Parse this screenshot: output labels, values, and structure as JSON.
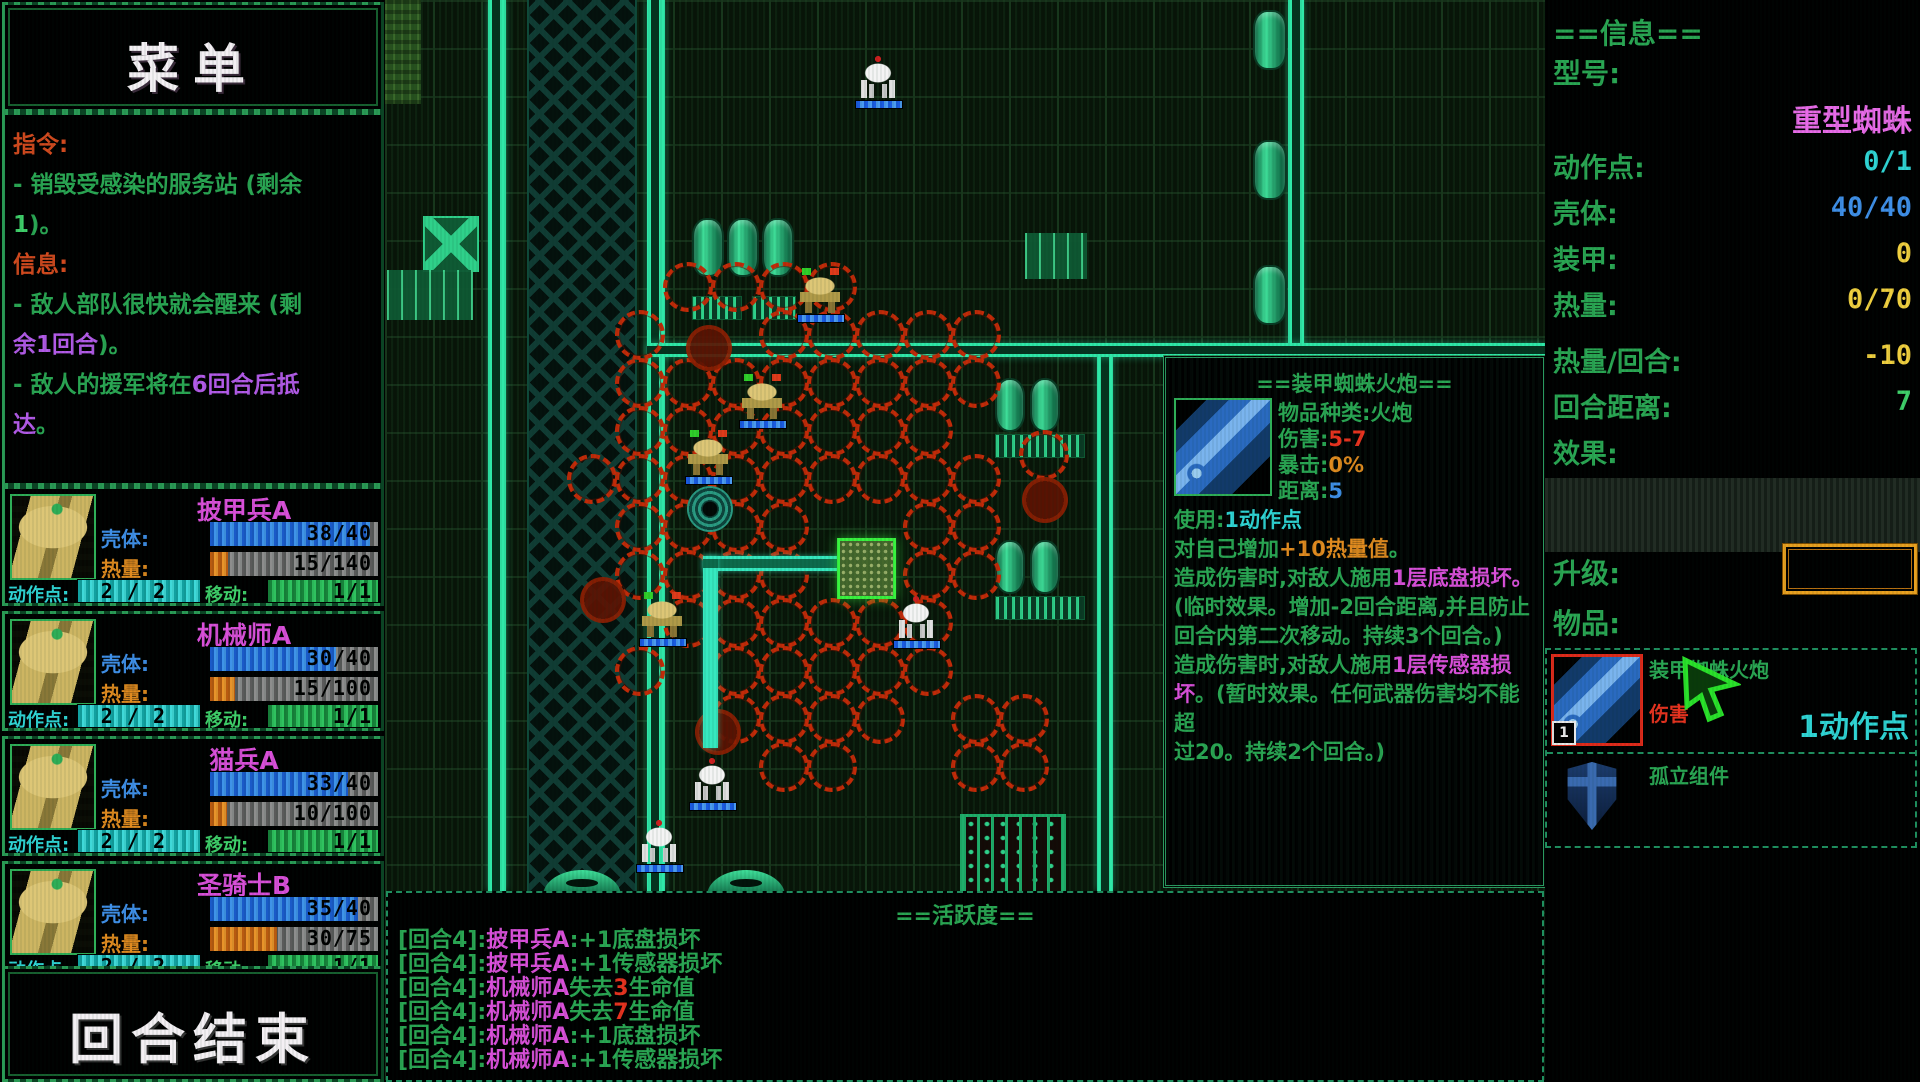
{
  "colors": {
    "accent_green": "#2aa653",
    "magenta": "#d94fd9",
    "cyan": "#2fd4d4",
    "blue": "#3f8fe8",
    "orange": "#e08a1f",
    "yellow": "#f0cf3f",
    "red": "#e8321f",
    "circle_red": "#c22a08",
    "conduit_teal": "#2fe8a8",
    "hp_blue": "#3f93e8"
  },
  "menu": {
    "title": "菜单"
  },
  "mission": {
    "lines": [
      [
        {
          "t": "指令:",
          "c": "o2"
        }
      ],
      [
        {
          "t": "- 销毁受感染的服务站 (剩余",
          "c": "g"
        }
      ],
      [
        {
          "t": "1",
          "c": "gb"
        },
        {
          "t": ")。",
          "c": "g"
        }
      ],
      [
        {
          "t": "信息:",
          "c": "o2"
        }
      ],
      [
        {
          "t": "- 敌人部队很快就会醒来 (剩",
          "c": "g"
        }
      ],
      [
        {
          "t": "余1回合",
          "c": "p"
        },
        {
          "t": ")。",
          "c": "g"
        }
      ],
      [
        {
          "t": "- 敌人的援军将在",
          "c": "g"
        },
        {
          "t": "6回合后抵",
          "c": "p"
        }
      ],
      [
        {
          "t": "达",
          "c": "p"
        },
        {
          "t": "。",
          "c": "g"
        }
      ]
    ]
  },
  "unit_labels": {
    "hull": "壳体:",
    "heat": "热量:",
    "ap": "动作点:",
    "mv": "移动:"
  },
  "units": [
    {
      "name": "披甲兵A",
      "hull": "38/40",
      "hull_pct": 95,
      "heat": "15/140",
      "heat_pct": 11,
      "ap": "2 / 2",
      "mv": "1/1"
    },
    {
      "name": "机械师A",
      "hull": "30/40",
      "hull_pct": 75,
      "heat": "15/100",
      "heat_pct": 15,
      "ap": "2 / 2",
      "mv": "1/1"
    },
    {
      "name": "猫兵A",
      "hull": "33/40",
      "hull_pct": 82,
      "heat": "10/100",
      "heat_pct": 10,
      "ap": "2 / 2",
      "mv": "1/1"
    },
    {
      "name": "圣骑士B",
      "hull": "35/40",
      "hull_pct": 88,
      "heat": "30/75",
      "heat_pct": 40,
      "ap": "2 / 2",
      "mv": "1/1"
    }
  ],
  "end_turn": {
    "label": "回合结束"
  },
  "info": {
    "title": "==信息==",
    "model_label": "型号:",
    "model": "重型蜘蛛",
    "rows": [
      {
        "label": "动作点:",
        "value": "0/1",
        "c": "c",
        "top": 146
      },
      {
        "label": "壳体:",
        "value": "40/40",
        "c": "b",
        "top": 192
      },
      {
        "label": "装甲:",
        "value": "0",
        "c": "y",
        "top": 238
      },
      {
        "label": "热量:",
        "value": "0/70",
        "c": "y",
        "top": 284
      },
      {
        "label": "热量/回合:",
        "value": "-10",
        "c": "y",
        "top": 340
      },
      {
        "label": "回合距离:",
        "value": "7",
        "c": "gb",
        "top": 386
      },
      {
        "label": "效果:",
        "value": "",
        "c": "g",
        "top": 432
      }
    ],
    "upgrade_label": "升级:",
    "items_label": "物品:"
  },
  "items": [
    {
      "name": "装甲蜘蛛火炮",
      "sub": "伤害",
      "ap": "1动作点",
      "badge": "1",
      "icon": "cannon",
      "selected": true
    },
    {
      "name": "孤立组件",
      "icon": "shield",
      "selected": false
    }
  ],
  "tooltip": {
    "title": "==装甲蜘蛛火炮==",
    "stats": [
      [
        {
          "t": "物品种类:火炮",
          "c": "g"
        }
      ],
      [
        {
          "t": "伤害:",
          "c": "g"
        },
        {
          "t": "5-7",
          "c": "r"
        }
      ],
      [
        {
          "t": "暴击:",
          "c": "g"
        },
        {
          "t": "0%",
          "c": "o"
        }
      ],
      [
        {
          "t": "距离:",
          "c": "g"
        },
        {
          "t": "5",
          "c": "b"
        }
      ]
    ],
    "body": [
      [
        {
          "t": "使用:",
          "c": "g"
        },
        {
          "t": "1动作点",
          "c": "c"
        }
      ],
      [
        {
          "t": "对自己增加",
          "c": "g"
        },
        {
          "t": "+10热量值",
          "c": "o"
        },
        {
          "t": "。",
          "c": "g"
        }
      ],
      [
        {
          "t": "造成伤害时,对敌人施用",
          "c": "g"
        },
        {
          "t": "1层底盘损坏。",
          "c": "m"
        }
      ],
      [
        {
          "t": "(临时效果。增加-2回合距离,并且防止",
          "c": "g"
        }
      ],
      [
        {
          "t": "回合内第二次移动。持续3个回合。)",
          "c": "g"
        }
      ],
      [
        {
          "t": "造成伤害时,对敌人施用",
          "c": "g"
        },
        {
          "t": "1层传感器损",
          "c": "m"
        }
      ],
      [
        {
          "t": "坏",
          "c": "m"
        },
        {
          "t": "。(暂时效果。任何武器伤害均不能超",
          "c": "g"
        }
      ],
      [
        {
          "t": "过20。持续2个回合。)",
          "c": "g"
        }
      ]
    ]
  },
  "log": {
    "title": "==活跃度==",
    "lines": [
      [
        {
          "t": "[回合4]:",
          "c": "g"
        },
        {
          "t": "披甲兵A",
          "c": "m"
        },
        {
          "t": ":+1底盘损坏",
          "c": "g"
        }
      ],
      [
        {
          "t": "[回合4]:",
          "c": "g"
        },
        {
          "t": "披甲兵A",
          "c": "m"
        },
        {
          "t": ":+1传感器损坏",
          "c": "g"
        }
      ],
      [
        {
          "t": "[回合4]:",
          "c": "g"
        },
        {
          "t": "机械师A",
          "c": "m"
        },
        {
          "t": "失去",
          "c": "g"
        },
        {
          "t": "3",
          "c": "r"
        },
        {
          "t": "生命值",
          "c": "g"
        }
      ],
      [
        {
          "t": "[回合4]:",
          "c": "g"
        },
        {
          "t": "机械师A",
          "c": "m"
        },
        {
          "t": "失去",
          "c": "g"
        },
        {
          "t": "7",
          "c": "r"
        },
        {
          "t": "生命值",
          "c": "g"
        }
      ],
      [
        {
          "t": "[回合4]:",
          "c": "g"
        },
        {
          "t": "机械师A",
          "c": "m"
        },
        {
          "t": ":+1底盘损坏",
          "c": "g"
        }
      ],
      [
        {
          "t": "[回合4]:",
          "c": "g"
        },
        {
          "t": "机械师A",
          "c": "m"
        },
        {
          "t": ":+1传感器损坏",
          "c": "g"
        }
      ]
    ]
  },
  "map": {
    "tile": 48,
    "hazard": {
      "x": 142,
      "y": 0,
      "w": 106,
      "h": 891
    },
    "lighttiles": {
      "x": 0,
      "y": 0,
      "w": 36,
      "h": 104
    },
    "conduits": [
      {
        "dir": "v",
        "x": 103,
        "y": 0,
        "w": 18,
        "h": 891
      },
      {
        "dir": "v",
        "x": 262,
        "y": 0,
        "w": 18,
        "h": 891
      },
      {
        "dir": "v",
        "x": 712,
        "y": 350,
        "w": 16,
        "h": 541
      },
      {
        "dir": "v",
        "x": 903,
        "y": 0,
        "w": 16,
        "h": 350
      },
      {
        "dir": "h",
        "x": 262,
        "y": 343,
        "w": 898,
        "h": 14
      }
    ],
    "path": [
      {
        "x": 318,
        "y": 556,
        "w": 142,
        "h": 15
      },
      {
        "x": 318,
        "y": 556,
        "w": 15,
        "h": 192
      }
    ],
    "selected": {
      "x": 452,
      "y": 538,
      "w": 53,
      "h": 55
    },
    "circles": [
      [
        300,
        284
      ],
      [
        348,
        284
      ],
      [
        396,
        284
      ],
      [
        444,
        284
      ],
      [
        252,
        332
      ],
      [
        396,
        332
      ],
      [
        444,
        332
      ],
      [
        492,
        332
      ],
      [
        540,
        332
      ],
      [
        588,
        332
      ],
      [
        252,
        380
      ],
      [
        300,
        380
      ],
      [
        348,
        380
      ],
      [
        396,
        380
      ],
      [
        444,
        380
      ],
      [
        492,
        380
      ],
      [
        540,
        380
      ],
      [
        588,
        380
      ],
      [
        252,
        428
      ],
      [
        300,
        428
      ],
      [
        348,
        428
      ],
      [
        396,
        428
      ],
      [
        444,
        428
      ],
      [
        492,
        428
      ],
      [
        540,
        428
      ],
      [
        656,
        452
      ],
      [
        204,
        476
      ],
      [
        252,
        476
      ],
      [
        300,
        476
      ],
      [
        348,
        476
      ],
      [
        396,
        476
      ],
      [
        444,
        476
      ],
      [
        492,
        476
      ],
      [
        540,
        476
      ],
      [
        588,
        476
      ],
      [
        252,
        524
      ],
      [
        300,
        524
      ],
      [
        348,
        524
      ],
      [
        396,
        524
      ],
      [
        540,
        524
      ],
      [
        588,
        524
      ],
      [
        252,
        572
      ],
      [
        300,
        572
      ],
      [
        348,
        572
      ],
      [
        396,
        572
      ],
      [
        540,
        572
      ],
      [
        588,
        572
      ],
      [
        300,
        620
      ],
      [
        348,
        620
      ],
      [
        396,
        620
      ],
      [
        444,
        620
      ],
      [
        492,
        620
      ],
      [
        540,
        620
      ],
      [
        252,
        668
      ],
      [
        348,
        668
      ],
      [
        396,
        668
      ],
      [
        444,
        668
      ],
      [
        492,
        668
      ],
      [
        540,
        668
      ],
      [
        348,
        716
      ],
      [
        396,
        716
      ],
      [
        444,
        716
      ],
      [
        492,
        716
      ],
      [
        588,
        716
      ],
      [
        636,
        716
      ],
      [
        396,
        764
      ],
      [
        444,
        764
      ],
      [
        588,
        764
      ],
      [
        636,
        764
      ]
    ],
    "solids": [
      [
        324,
        348
      ],
      [
        660,
        500
      ],
      [
        218,
        600
      ],
      [
        333,
        732
      ]
    ],
    "units": [
      {
        "t": "spider",
        "x": 470,
        "y": 54
      },
      {
        "t": "spider",
        "x": 508,
        "y": 594
      },
      {
        "t": "spider",
        "x": 304,
        "y": 756
      },
      {
        "t": "spider",
        "x": 251,
        "y": 818
      },
      {
        "t": "mech",
        "x": 412,
        "y": 268
      },
      {
        "t": "mech",
        "x": 354,
        "y": 374
      },
      {
        "t": "mech",
        "x": 300,
        "y": 430
      },
      {
        "t": "mech",
        "x": 254,
        "y": 592
      },
      {
        "t": "vortex",
        "x": 302,
        "y": 486
      }
    ],
    "objects": [
      {
        "t": "cratex",
        "x": 38,
        "y": 216,
        "w": 52,
        "h": 52
      },
      {
        "t": "crates",
        "x": 2,
        "y": 270,
        "w": 86,
        "h": 50
      },
      {
        "t": "crates",
        "x": 640,
        "y": 233,
        "w": 62,
        "h": 46
      },
      {
        "t": "pod",
        "x": 307,
        "y": 218,
        "w": 28,
        "h": 55
      },
      {
        "t": "pod",
        "x": 342,
        "y": 218,
        "w": 28,
        "h": 55
      },
      {
        "t": "pod",
        "x": 377,
        "y": 218,
        "w": 28,
        "h": 55
      },
      {
        "t": "grate",
        "x": 307,
        "y": 296,
        "w": 48,
        "h": 22
      },
      {
        "t": "grate",
        "x": 367,
        "y": 296,
        "w": 42,
        "h": 22
      },
      {
        "t": "pod",
        "x": 868,
        "y": 10,
        "w": 30,
        "h": 56
      },
      {
        "t": "pod",
        "x": 868,
        "y": 140,
        "w": 30,
        "h": 56
      },
      {
        "t": "pod",
        "x": 868,
        "y": 265,
        "w": 30,
        "h": 56
      },
      {
        "t": "pod",
        "x": 610,
        "y": 378,
        "w": 26,
        "h": 50
      },
      {
        "t": "pod",
        "x": 645,
        "y": 378,
        "w": 26,
        "h": 50
      },
      {
        "t": "grate",
        "x": 610,
        "y": 434,
        "w": 88,
        "h": 22
      },
      {
        "t": "pod",
        "x": 610,
        "y": 540,
        "w": 26,
        "h": 50
      },
      {
        "t": "pod",
        "x": 645,
        "y": 540,
        "w": 26,
        "h": 50
      },
      {
        "t": "grate",
        "x": 610,
        "y": 596,
        "w": 88,
        "h": 22
      },
      {
        "t": "vent",
        "x": 158,
        "y": 870,
        "w": 78,
        "h": 26
      },
      {
        "t": "vent",
        "x": 322,
        "y": 870,
        "w": 78,
        "h": 26
      },
      {
        "t": "fence",
        "x": 575,
        "y": 814,
        "w": 100,
        "h": 76
      }
    ]
  }
}
